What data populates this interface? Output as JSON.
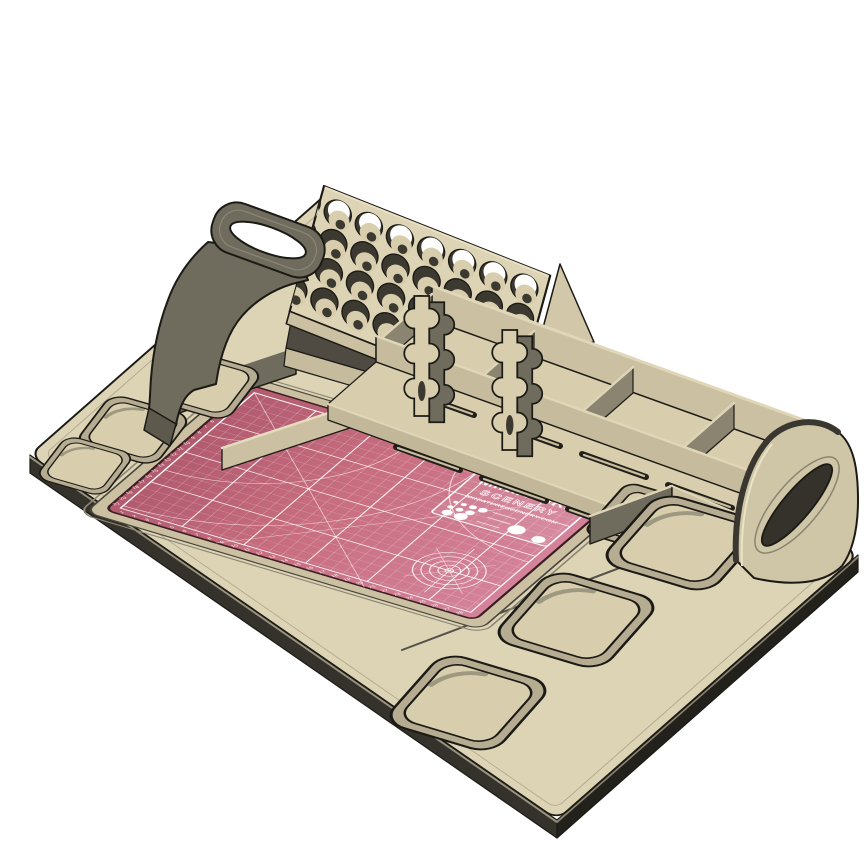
{
  "scene": {
    "object": "miniature-painting-workstation-render",
    "background": "#ffffff"
  },
  "colors": {
    "outline": "#1c1a15",
    "wood_top": "#ddd3b5",
    "wood_light_edge": "#ece3c6",
    "wood_mid": "#cbc1a2",
    "wood_floor": "#d8cead",
    "wood_step": "#b3aa8f",
    "side_dark": "#6f6b5d",
    "side_deep": "#35322b",
    "shadow_dark": "#4f4b42",
    "hole_dark": "#3c3930",
    "mat_dark": "#b15a6e",
    "mat_main": "#c86e80",
    "mat_light": "#d4839a",
    "mat_line": "#ffffff",
    "white": "#ffffff"
  },
  "paint_rack": {
    "rows": 4,
    "cols": 7,
    "hole_count": 28
  },
  "cutting_mat": {
    "brand_line1": "MINIATURE",
    "brand_line2": "SCENERY",
    "website": "MINIATURESCENERY.COM",
    "grid_minor_step": 10,
    "grid_major_step": 50,
    "bottom_edge_numbers": [
      1,
      2,
      3,
      4,
      5,
      6,
      7,
      8,
      9,
      10,
      11,
      12,
      13,
      14,
      15,
      16,
      17,
      18,
      19,
      20,
      21,
      22,
      23,
      24,
      25,
      26,
      27,
      28
    ],
    "left_edge_numbers": [
      1,
      2,
      3,
      4,
      5,
      6,
      7,
      8,
      9,
      10,
      11,
      12,
      13,
      14,
      15,
      16,
      17,
      18,
      19,
      20,
      21
    ]
  },
  "left_tray": {
    "recess_count": 3
  },
  "right_tray": {
    "recess_count": 3
  },
  "organizer": {
    "compartment_count": 4,
    "slot_count": 7
  },
  "brush_rests": {
    "count": 2
  },
  "handles": {
    "left": "carry-handle",
    "right": "carry-handle"
  }
}
